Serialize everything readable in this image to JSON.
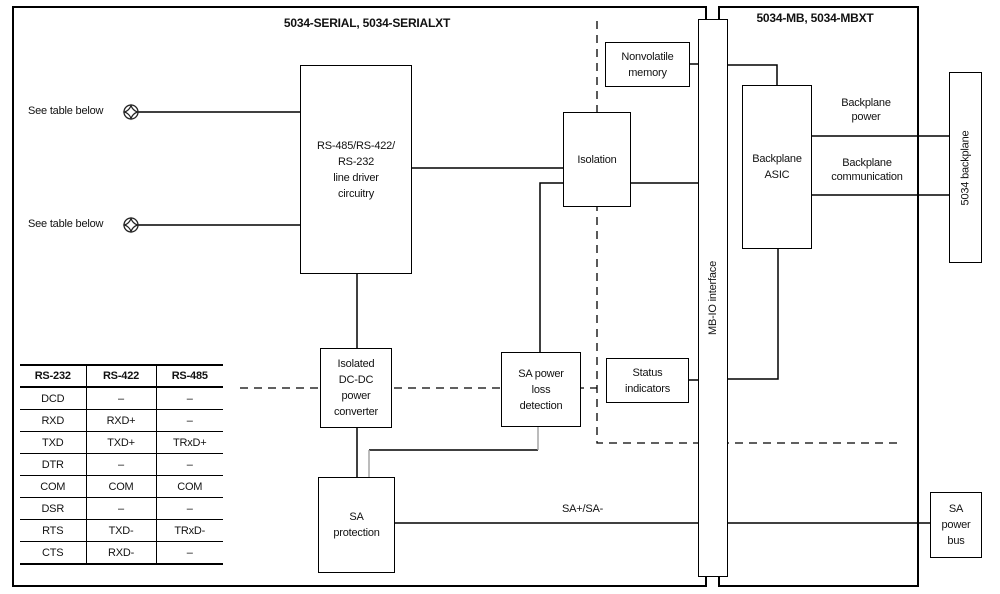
{
  "colors": {
    "line": "#000000",
    "muted_line": "#a6a6a6",
    "background": "#ffffff",
    "text": "#111111"
  },
  "titles": {
    "serial": "5034-SERIAL, 5034-SERIALXT",
    "mb": "5034-MB, 5034-MBXT"
  },
  "blocks": {
    "line_driver": "RS-485/RS-422/\nRS-232\nline driver\ncircuitry",
    "nonvolatile_memory": "Nonvolatile\nmemory",
    "isolation": "Isolation",
    "backplane_asic": "Backplane\nASIC",
    "backplane_5034": "5034 backplane",
    "mb_io_interface": "MB-IO interface",
    "dcdc_converter": "Isolated\nDC-DC\npower\nconverter",
    "sa_power_loss": "SA power\nloss\ndetection",
    "status_indicators": "Status\nindicators",
    "sa_protection": "SA\nprotection",
    "sa_power_bus": "SA\npower\nbus"
  },
  "labels": {
    "see_table_1": "See table below",
    "see_table_2": "See table below",
    "backplane_power": "Backplane\npower",
    "backplane_communication": "Backplane\ncommunication",
    "sa_bus_line": "SA+/SA-"
  },
  "pin_table": {
    "headers": [
      "RS-232",
      "RS-422",
      "RS-485"
    ],
    "rows": [
      [
        "DCD",
        "–",
        "–"
      ],
      [
        "RXD",
        "RXD+",
        "–"
      ],
      [
        "TXD",
        "TXD+",
        "TRxD+"
      ],
      [
        "DTR",
        "–",
        "–"
      ],
      [
        "COM",
        "COM",
        "COM"
      ],
      [
        "DSR",
        "–",
        "–"
      ],
      [
        "RTS",
        "TXD-",
        "TRxD-"
      ],
      [
        "CTS",
        "RXD-",
        "–"
      ]
    ]
  }
}
